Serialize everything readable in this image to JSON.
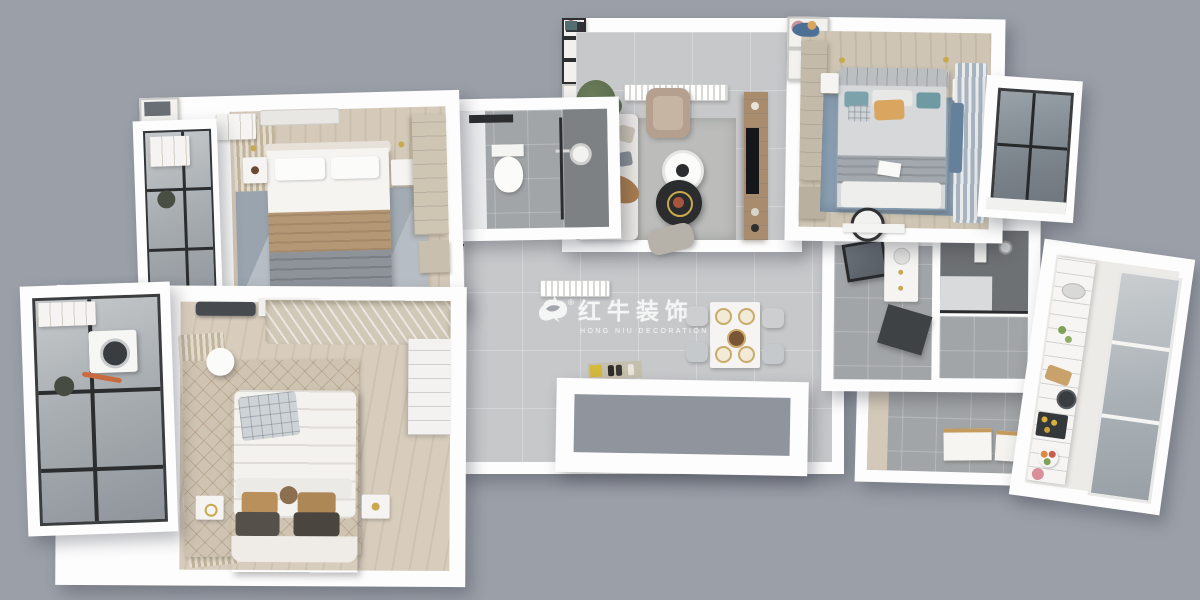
{
  "meta": {
    "description": "3D isometric top-down floor plan rendering of a furnished apartment on a flat gray backdrop",
    "render_type": "3d-floor-plan",
    "background_color": "#9b9fa8"
  },
  "watermark": {
    "brand_cn": "红牛装饰",
    "brand_en": "HONG NIU DECORATION",
    "registered": "®",
    "color": "#ffffff"
  },
  "palette": {
    "background": "#9b9fa8",
    "wall_white": "#fdfdfd",
    "tile_gray": "#c7c8ca",
    "bath_tile": "#a2a5a7",
    "dark_tile": "#6e7173",
    "wood_light": "#d5caba",
    "wood_cabinet": "#cfc5b3",
    "tv_wall_wood": "#a98c6e",
    "rug_blue": "#8ba0b2",
    "rug_gray": "#b7bdc4",
    "rug_beige": "#cfc3b1",
    "blanket_tan": "#b49876",
    "pillow_teal": "#7ca3ac",
    "pillow_orange": "#d9a55f",
    "frame_black": "#2c2e30",
    "gold_accent": "#c8a94e",
    "plant_green": "#5c6e4e"
  },
  "rooms": [
    {
      "name": "hallway-dining",
      "floor": "gray-tile",
      "furniture": [
        "dining-table",
        "dining-chairs",
        "wall-picture",
        "radiator",
        "doormat-with-shoes",
        "open-door"
      ]
    },
    {
      "name": "entry-porch",
      "floor": "dark-gray"
    },
    {
      "name": "utility-room",
      "floor": "gray-tile",
      "furniture": [
        "leaning-canvases",
        "glass-partition"
      ]
    },
    {
      "name": "master-bathroom",
      "floor": "gray-tile",
      "furniture": [
        "mirror",
        "vanity",
        "dark-counter"
      ]
    },
    {
      "name": "shower-room",
      "floor": "dark-tile",
      "furniture": [
        "shower-column",
        "glass-screen"
      ]
    },
    {
      "name": "kitchen",
      "floor": "white-tile",
      "furniture": [
        "counter",
        "sink",
        "cutting-board",
        "stove",
        "fruit-bowl",
        "window-band"
      ]
    },
    {
      "name": "living-room",
      "floor": "gray-tile",
      "furniture": [
        "gallery-wall",
        "radiator",
        "plant",
        "sofa",
        "armchair",
        "coffee-tables",
        "rug",
        "tv-wall",
        "ottoman"
      ]
    },
    {
      "name": "guest-bathroom",
      "floor": "gray-tile",
      "furniture": [
        "toilet",
        "shower-head",
        "glass-partition",
        "towel-bar"
      ]
    },
    {
      "name": "second-bedroom",
      "floor": "light-wood",
      "furniture": [
        "double-bed",
        "tan-blanket",
        "nightstands",
        "wall-frames",
        "wardrobe",
        "curtains",
        "rug",
        "air-conditioner"
      ]
    },
    {
      "name": "north-balcony",
      "floor": "glass-windows",
      "furniture": [
        "cabinet",
        "plant"
      ]
    },
    {
      "name": "third-bedroom",
      "floor": "light-wood",
      "furniture": [
        "double-bed",
        "teal-pillows",
        "orange-pillow",
        "blue-rug",
        "wardrobe",
        "curtains",
        "wall-frames",
        "desk-chair",
        "nightstands"
      ]
    },
    {
      "name": "bay-window",
      "floor": "glass"
    },
    {
      "name": "master-bedroom",
      "floor": "light-wood",
      "furniture": [
        "double-bed",
        "plaid-blanket",
        "brown-pillows",
        "diamond-rug",
        "open-closet",
        "air-conditioner",
        "curtains",
        "nightstands",
        "side-table",
        "white-wardrobe"
      ]
    },
    {
      "name": "laundry-balcony",
      "floor": "glass-windows",
      "furniture": [
        "washing-machine",
        "plant",
        "shelf"
      ]
    }
  ]
}
